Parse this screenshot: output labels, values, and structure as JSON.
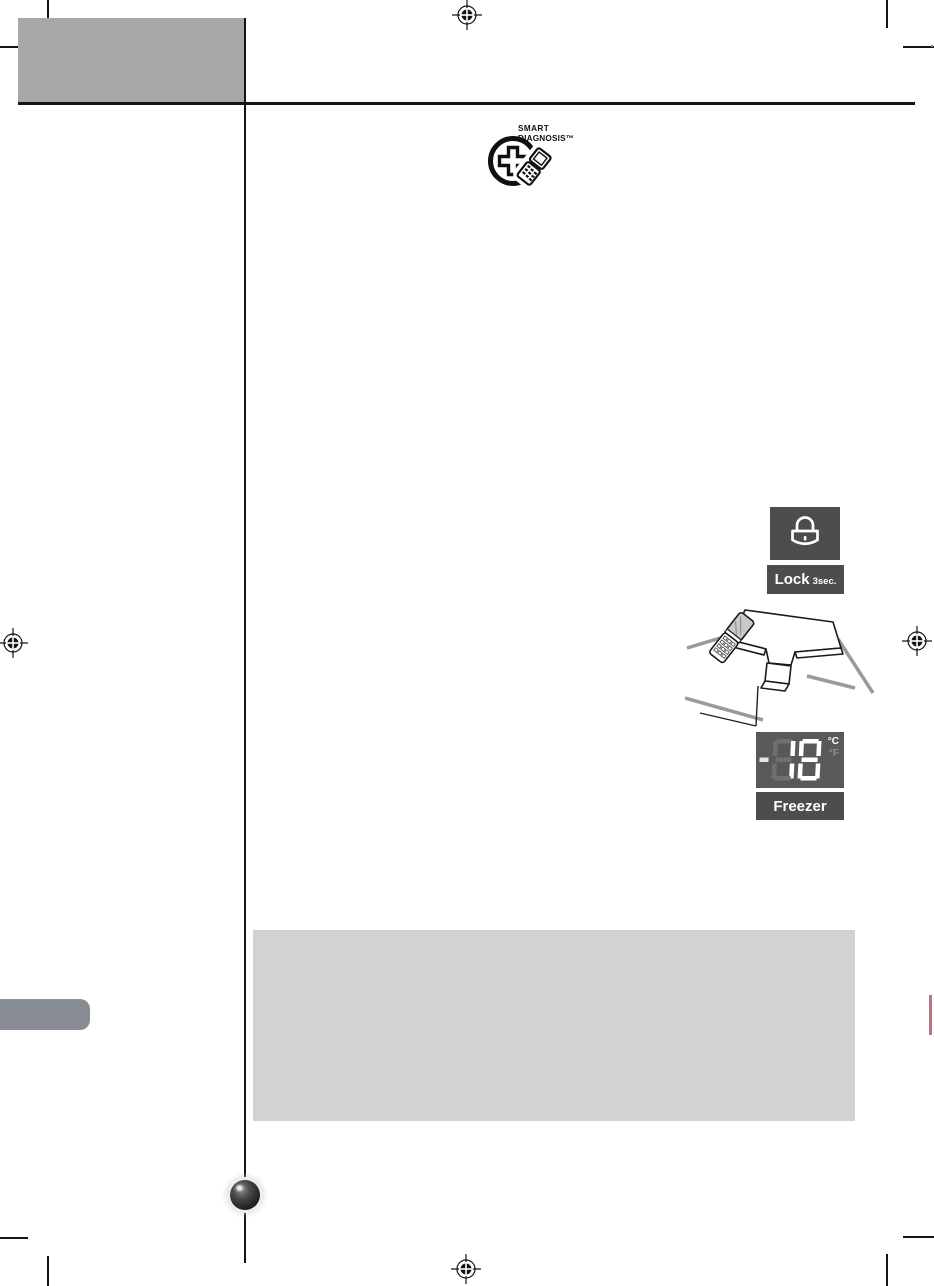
{
  "branding": {
    "smart_diagnosis_line1": "SMART",
    "smart_diagnosis_line2": "DIAGNOSIS™"
  },
  "control_panel": {
    "lock_button_label": "Lock",
    "lock_hold_duration": "3sec.",
    "temperature_value": "-18",
    "temperature_unit_primary": "°C",
    "temperature_unit_secondary": "°F",
    "freezer_button_label": "Freezer"
  },
  "colors": {
    "header_block_gray": "#a8a8a8",
    "note_block_gray": "#d2d2d2",
    "button_dark_gray": "#4d4d4d",
    "display_dark_gray": "#58595b",
    "segment_ghost_gray": "#6e6f71",
    "segment_lit_white": "#ffffff",
    "side_tab_gray": "#878d92",
    "edge_mark_red": "#c4717c",
    "rule_black": "#141414"
  },
  "icons": {
    "registration_mark": "crosshair-target",
    "lock_icon": "padlock-outline",
    "smart_diagnosis_icon": "plus-circle-with-flip-phone",
    "illustration": "phone-held-to-display-panel",
    "page_marker": "glossy-sphere"
  }
}
